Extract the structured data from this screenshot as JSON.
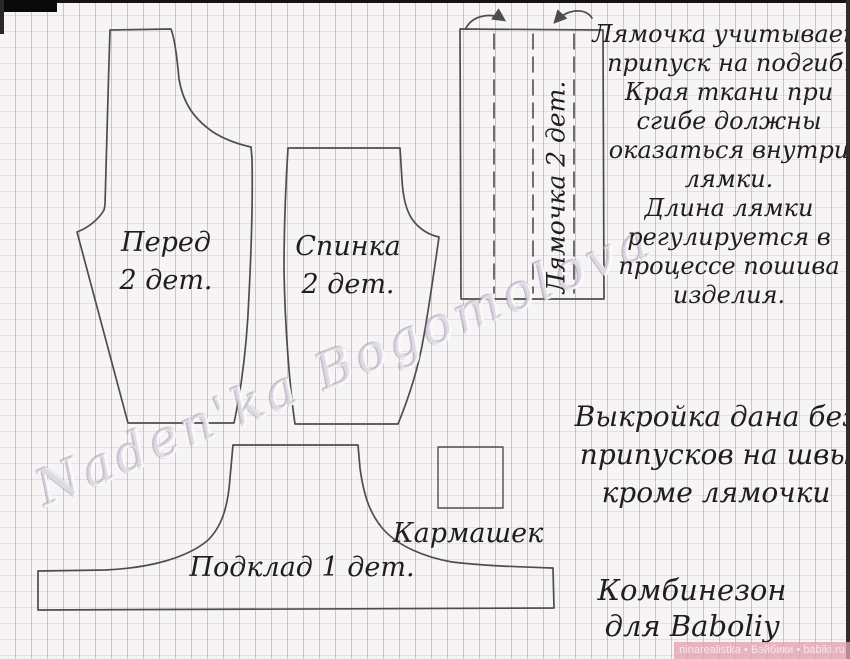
{
  "pieces": {
    "front": {
      "name": "Перед",
      "qty": "2 дет."
    },
    "back": {
      "name": "Спинка",
      "qty": "2 дет."
    },
    "strap": {
      "label": "Лямочка 2 дет."
    },
    "lining": {
      "label": "Подклад 1 дет."
    },
    "pocket": {
      "label": "Кармашек"
    }
  },
  "notes": {
    "strap_note_lines": [
      "Лямочка учитывает",
      "припуск на подгиб.",
      "Края ткани при",
      "сгибе должны",
      "оказаться внутри",
      "лямки.",
      "Длина лямки",
      "регулируется в",
      "процессе пошива",
      "изделия."
    ],
    "allowance_lines": [
      "Выкройка дана без",
      "припусков на швы",
      "кроме лямочки"
    ],
    "title_lines": [
      "Комбинезон",
      "для Baboliy"
    ]
  },
  "watermark": "Naden'ka Bogomolova",
  "credit": "ninarealistka • Бэйбики • babiki.ru",
  "colors": {
    "paper": "#f6f4f5",
    "grid_vertical": "#8b6baf",
    "grid_horizontal": "#cda0be",
    "outline": "#4f4d4c",
    "ink": "#1f1d1e",
    "credit_bg": "#e2a3b2",
    "credit_text": "#ffe3e9"
  }
}
